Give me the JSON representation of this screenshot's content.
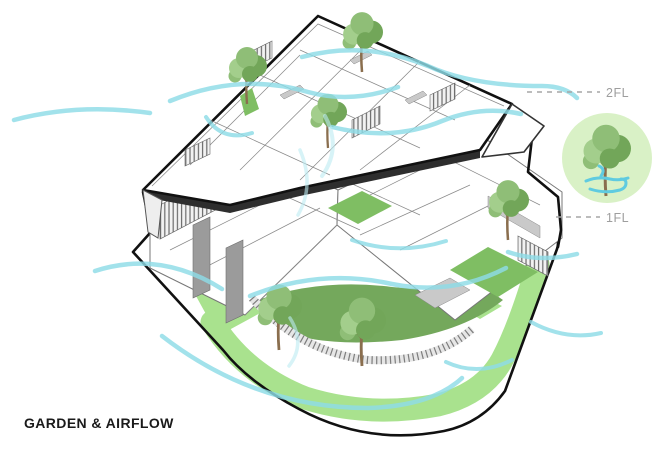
{
  "title": "GARDEN & AIRFLOW",
  "floor_labels": [
    {
      "id": "2fl",
      "label": "2FL"
    },
    {
      "id": "1fl",
      "label": "1FL"
    }
  ],
  "legend": {
    "symbol": "tree-with-airflow"
  },
  "colors": {
    "airflow": "#8EDCE6",
    "airflow_light": "#BDEBF2",
    "lawn": "#A9E28E",
    "garden": "#74A85C",
    "court_green": "#7FBE63",
    "legend_bg": "#D9F1C6",
    "tree_light": "#A3CE8C",
    "tree_mid": "#8FBE77",
    "tree_dark": "#72A659",
    "trunk": "#8A6E4E",
    "outline": "#111111",
    "label_gray": "#9E9E9E",
    "wall_gray": "#9B9B9B",
    "title_color": "#1A1A1A"
  },
  "diagram": {
    "trees_2fl": [
      {
        "x": 247,
        "y": 104,
        "s": 1.0
      },
      {
        "x": 362,
        "y": 72,
        "s": 1.05
      },
      {
        "x": 328,
        "y": 148,
        "s": 0.95
      }
    ],
    "trees_1fl": [
      {
        "x": 279,
        "y": 350,
        "s": 1.15
      },
      {
        "x": 362,
        "y": 366,
        "s": 1.2
      },
      {
        "x": 508,
        "y": 240,
        "s": 1.05
      }
    ],
    "airflow_paths": [
      {
        "d": "M14,120 Q78,103 150,113",
        "w": 4.5
      },
      {
        "d": "M170,101 Q240,72 308,92 Q352,104 398,87",
        "w": 4.5
      },
      {
        "d": "M302,57 Q365,40 428,66 Q472,86 542,86 Q565,86 577,98",
        "w": 4.5
      },
      {
        "d": "M206,117 Q222,142 252,133",
        "w": 4
      },
      {
        "d": "M332,127 Q392,142 442,121 Q482,105 521,114",
        "w": 4.5
      },
      {
        "d": "M325,116 Q342,148 322,176",
        "w": 4,
        "light": true
      },
      {
        "d": "M300,150 Q315,185 298,215",
        "w": 3.5,
        "light": true
      },
      {
        "d": "M95,271 Q160,250 222,289",
        "w": 4.5
      },
      {
        "d": "M162,336 Q255,408 368,408 Q432,406 462,378",
        "w": 4.5
      },
      {
        "d": "M250,296 Q320,268 392,284 Q452,296 506,268",
        "w": 4.5
      },
      {
        "d": "M352,240 Q398,256 446,241",
        "w": 4
      },
      {
        "d": "M508,252 Q540,263 577,254",
        "w": 4.5
      },
      {
        "d": "M446,362 Q478,377 512,360",
        "w": 4
      },
      {
        "d": "M531,322 Q566,341 601,333",
        "w": 4
      },
      {
        "d": "M290,318 Q306,344 289,366",
        "w": 3.5,
        "light": true
      }
    ]
  }
}
